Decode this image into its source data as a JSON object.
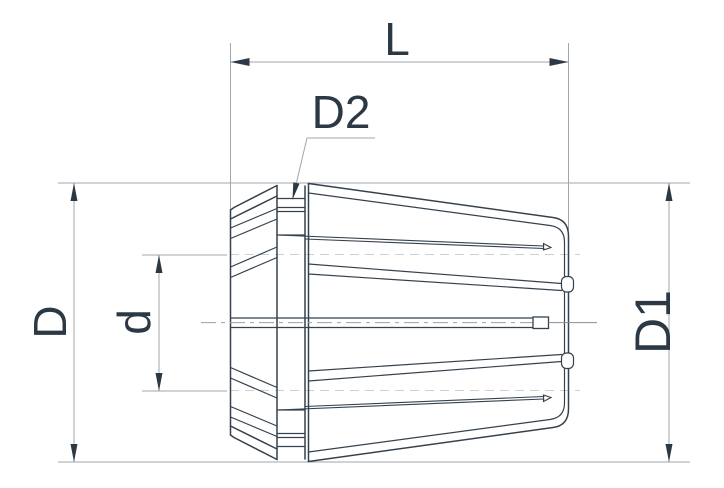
{
  "drawing": {
    "title": "ER collet dimension drawing",
    "labels": {
      "length": "L",
      "neck_diameter": "D2",
      "back_diameter": "D",
      "bore_diameter": "d",
      "front_diameter": "D1"
    },
    "colors": {
      "line_dark": "#35424e",
      "text_dark": "#2c3945",
      "dim_gray": "#a0a6ab",
      "faint_dash": "#cdd1d4",
      "centerline": "#9aa0a5",
      "background": "#ffffff"
    }
  }
}
